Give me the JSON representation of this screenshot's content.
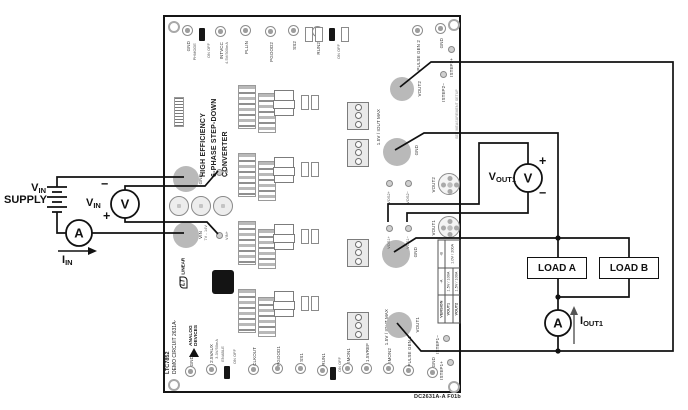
{
  "figure": {
    "caption": "DC2631A-A F01b"
  },
  "input": {
    "supply": {
      "label_main": "V",
      "label_sub": "IN",
      "label_line2": "SUPPLY"
    },
    "voltmeter": {
      "letter": "V",
      "label_main": "V",
      "label_sub": "IN",
      "minus": "−",
      "plus": "+"
    },
    "ammeter": {
      "letter": "A"
    },
    "current": {
      "label_main": "I",
      "label_sub": "IN"
    }
  },
  "output": {
    "voltmeter": {
      "letter": "V",
      "label_main": "V",
      "label_sub": "OUT1",
      "plus": "+",
      "minus": "−"
    },
    "ammeter": {
      "letter": "A"
    },
    "current": {
      "label_main": "I",
      "label_sub": "OUT1"
    },
    "load_a": "LOAD A",
    "load_b": "LOAD B"
  },
  "board": {
    "title_line1": "HIGH EFFICIENCY",
    "title_line2": "6-PHASE STEP-DOWN",
    "title_line3": "CONVERTER",
    "silk_part": "LTC7852",
    "silk_demo": "DEMO CIRCUIT 2631A-",
    "brand_analog_1": "ANALOG",
    "brand_analog_2": "DEVICES",
    "brand_lt": "LT",
    "brand_linear": "LINEAR",
    "edge_note": "SEE MEASUREMENT SETUP",
    "top_edge": {
      "pins": [
        "GND",
        "INTVCC",
        "PLLIN",
        "PGOOD2",
        "SS2",
        "RUN2"
      ],
      "intvcc_sub": "4.5V/500mA",
      "jumper1_label": "PHMODE",
      "jumper1_states": "ON OFF",
      "jumper2_states": "ON OFF"
    },
    "right_edge": {
      "pins_top": [
        "PULSE GEN 2",
        "GND",
        "ISTEP2+",
        "ISTEP2−"
      ],
      "pins_bottom": [
        "ISTEP1−",
        "ISTEP1+"
      ]
    },
    "bottom_edge": {
      "pins": [
        "GND",
        "2.5VAUX",
        "CLKOUT",
        "PGOOD1",
        "SS1",
        "RUN1",
        "IMON1",
        "1.5VREF",
        "IMON2",
        "PULSE GEN 1",
        "GND"
      ],
      "aux_sub": "3.3V/50mA",
      "jumper1_label": "ENABLE",
      "jumper1_states": "ON OFF",
      "jumper2_states": "ON OFF"
    },
    "left_edge": {
      "gnd_pad": "GND",
      "vin_pad": "VIN",
      "vin_rating": "7V - 14V",
      "vin_sense_minus": "VIN−",
      "vin_sense_plus": "VIN+"
    },
    "output_area": {
      "pads": [
        "VOUT2",
        "GND",
        "GND",
        "VOUT1"
      ],
      "sense_pins": [
        "VOS2+",
        "VOS2−",
        "VOS1+",
        "VOS1−"
      ],
      "connectors": [
        "VOUT2",
        "VOUT1"
      ],
      "ratings": [
        "1.5V / IOUT MAX",
        "1.5V / IOUT MAX"
      ]
    },
    "version_table": {
      "col_headers": [
        "VERSION",
        "VOUT1",
        "VOUT2"
      ],
      "row_a": {
        "name": "-A",
        "vout1": "1.5V / 100A",
        "vout2": "1.5V / 100A"
      },
      "row_b": {
        "name": "-B",
        "value": "1.0V / 200A"
      }
    }
  }
}
